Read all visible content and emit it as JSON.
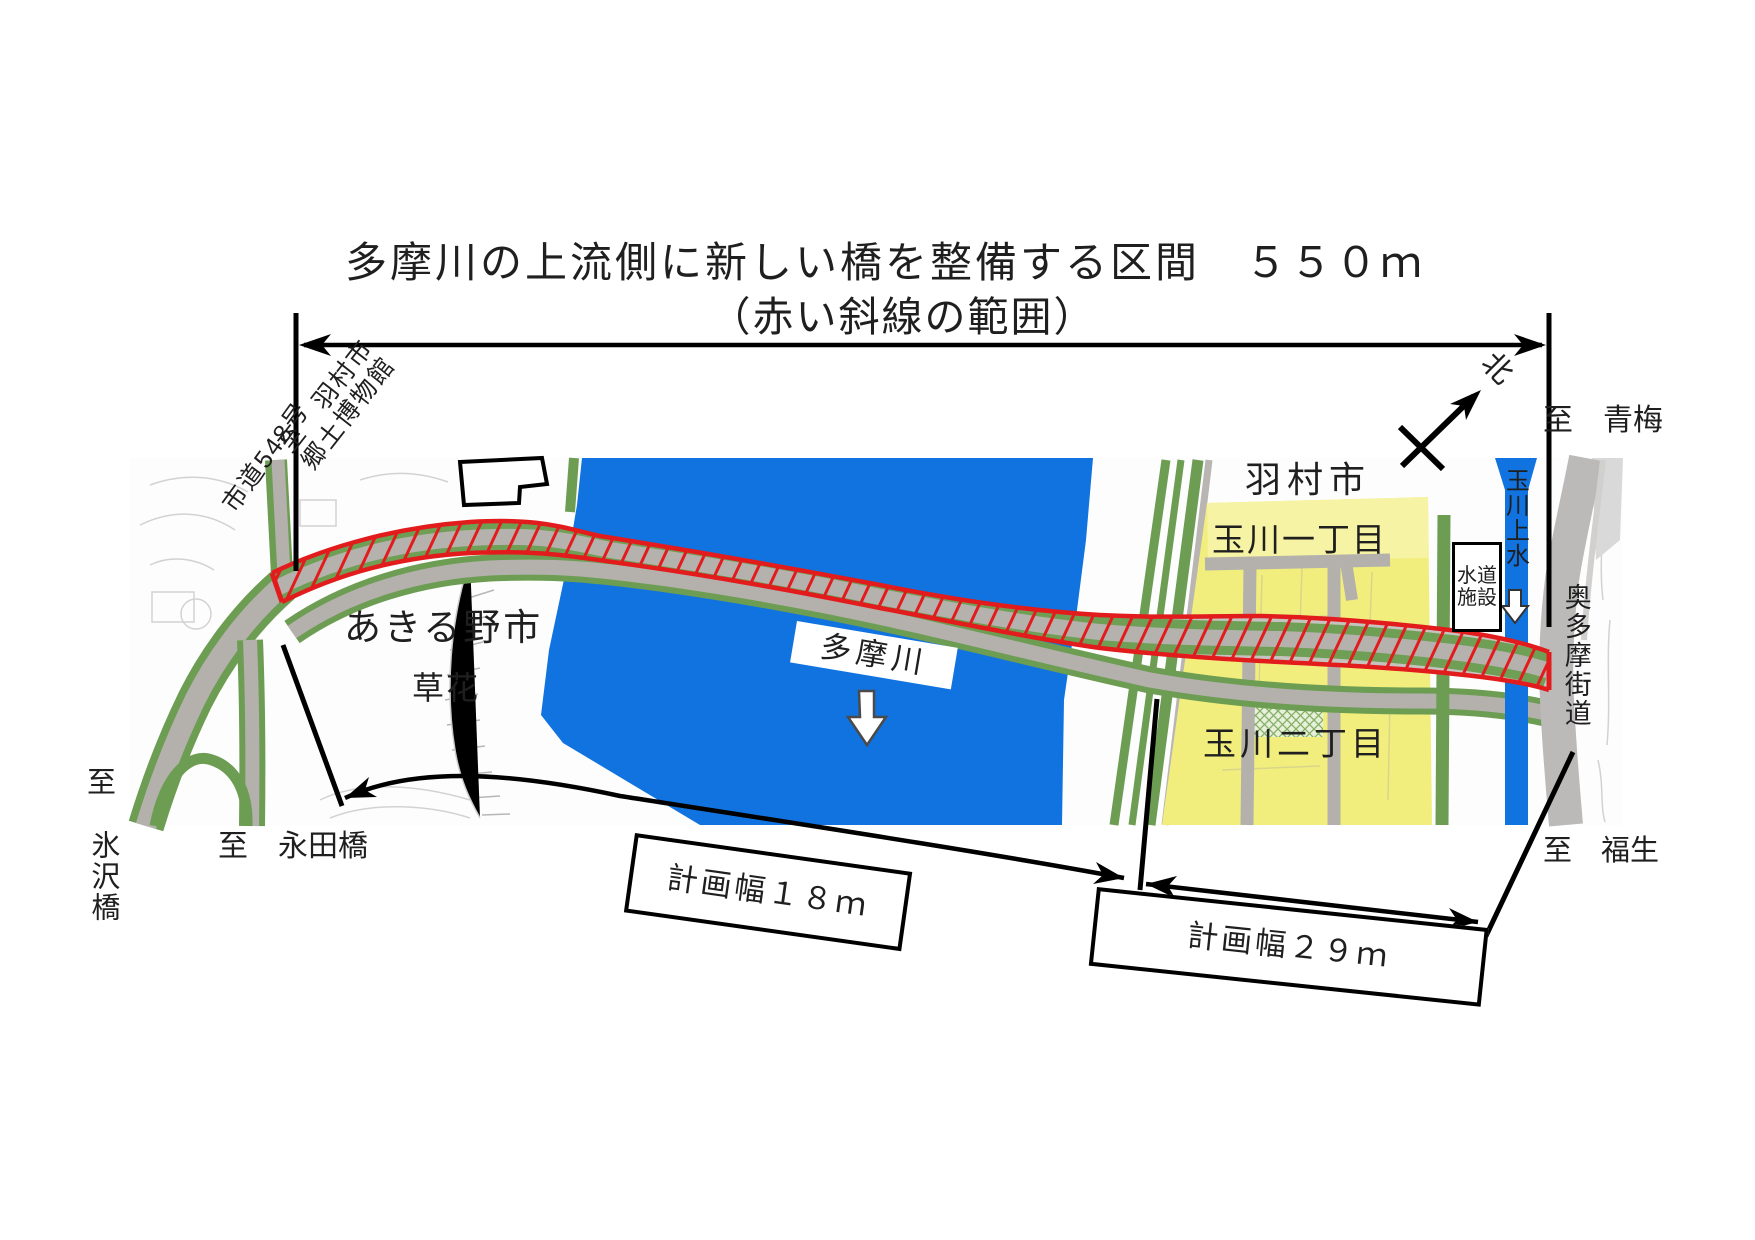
{
  "title": {
    "line1": "多摩川の上流側に新しい橋を整備する区間　５５０ｍ",
    "line2": "（赤い斜線の範囲）"
  },
  "annotations": {
    "road_548": "市道548号",
    "to_hamura_museum_line1": "至　羽村市",
    "to_hamura_museum_line2": "郷土博物館",
    "north_label": "北",
    "to_ome": "至　青梅",
    "to_hisawa_prefix": "至",
    "to_hisawa_bridge": "氷沢橋",
    "to_nagata_bridge": "至　永田橋",
    "to_fussa": "至　福生",
    "plan_width_18m": "計画幅１８ｍ",
    "plan_width_29m": "計画幅２９ｍ"
  },
  "map": {
    "hamura_city": "羽村市",
    "tamagawa_1chome": "玉川一丁目",
    "tamagawa_2chome": "玉川二丁目",
    "akiruno_city": "あきる野市",
    "kusabana": "草花",
    "tama_river": "多摩川",
    "water_facility_line1": "水道",
    "water_facility_line2": "施設",
    "tamagawa_josui": "玉川上水",
    "okutama_kaido": "奥多摩街道"
  },
  "colors": {
    "river_blue": "#1173df",
    "district_yellow": "#f1ee7d",
    "road_gray": "#b4b1ad",
    "roadside_green": "#6d9d53",
    "corridor_red": "#e21c1c",
    "annotation_black": "#000000"
  }
}
